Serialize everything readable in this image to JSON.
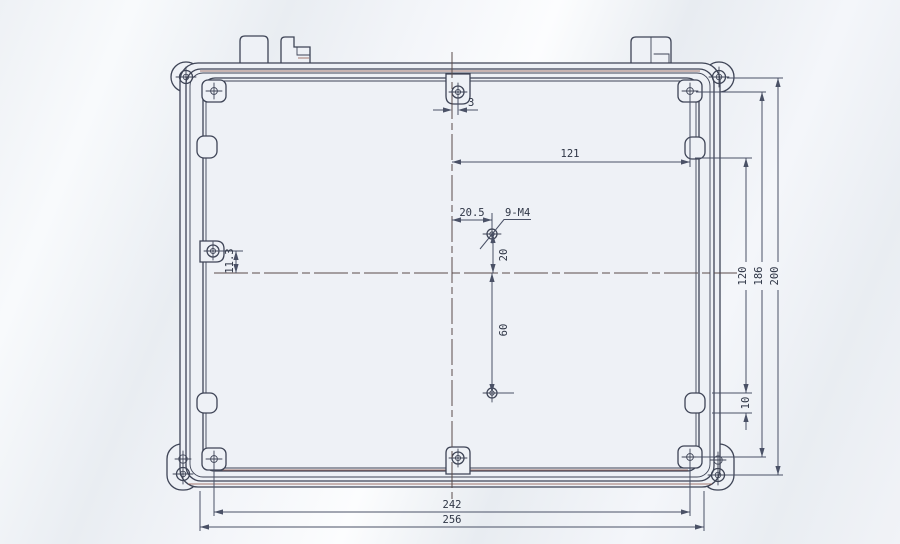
{
  "canvas": {
    "width": 900,
    "height": 544
  },
  "drawing": {
    "type": "technical-drawing",
    "subject": "enclosure-lid-inside-view",
    "colors": {
      "paper": "#eef1f6",
      "line": "#3e4456",
      "dim": "#4a5166",
      "text": "#2e3545",
      "centerline": "#5a4b4b",
      "accent": "#8a4f41"
    },
    "dimensions": [
      {
        "label": "3",
        "x": 468,
        "y": 106,
        "rot": false,
        "anchor": "start"
      },
      {
        "label": "121",
        "x": 570,
        "y": 157,
        "rot": false,
        "anchor": "middle"
      },
      {
        "label": "20.5",
        "x": 472,
        "y": 216,
        "rot": false,
        "anchor": "middle"
      },
      {
        "label": "20",
        "x": 507,
        "y": 255,
        "rot": true,
        "anchor": "middle"
      },
      {
        "label": "60",
        "x": 507,
        "y": 330,
        "rot": true,
        "anchor": "middle"
      },
      {
        "label": "11.3",
        "x": 233,
        "y": 261,
        "rot": true,
        "anchor": "middle"
      },
      {
        "label": "120",
        "x": 746,
        "y": 276,
        "rot": true,
        "anchor": "middle"
      },
      {
        "label": "186",
        "x": 762,
        "y": 276,
        "rot": true,
        "anchor": "middle"
      },
      {
        "label": "200",
        "x": 778,
        "y": 276,
        "rot": true,
        "anchor": "middle"
      },
      {
        "label": "10",
        "x": 749,
        "y": 403,
        "rot": true,
        "anchor": "middle"
      },
      {
        "label": "242",
        "x": 452,
        "y": 508,
        "rot": false,
        "anchor": "middle"
      },
      {
        "label": "256",
        "x": 452,
        "y": 523,
        "rot": false,
        "anchor": "middle"
      }
    ],
    "annotations": [
      {
        "label": "9-M4",
        "x": 505,
        "y": 216,
        "rot": false,
        "anchor": "start"
      }
    ]
  }
}
